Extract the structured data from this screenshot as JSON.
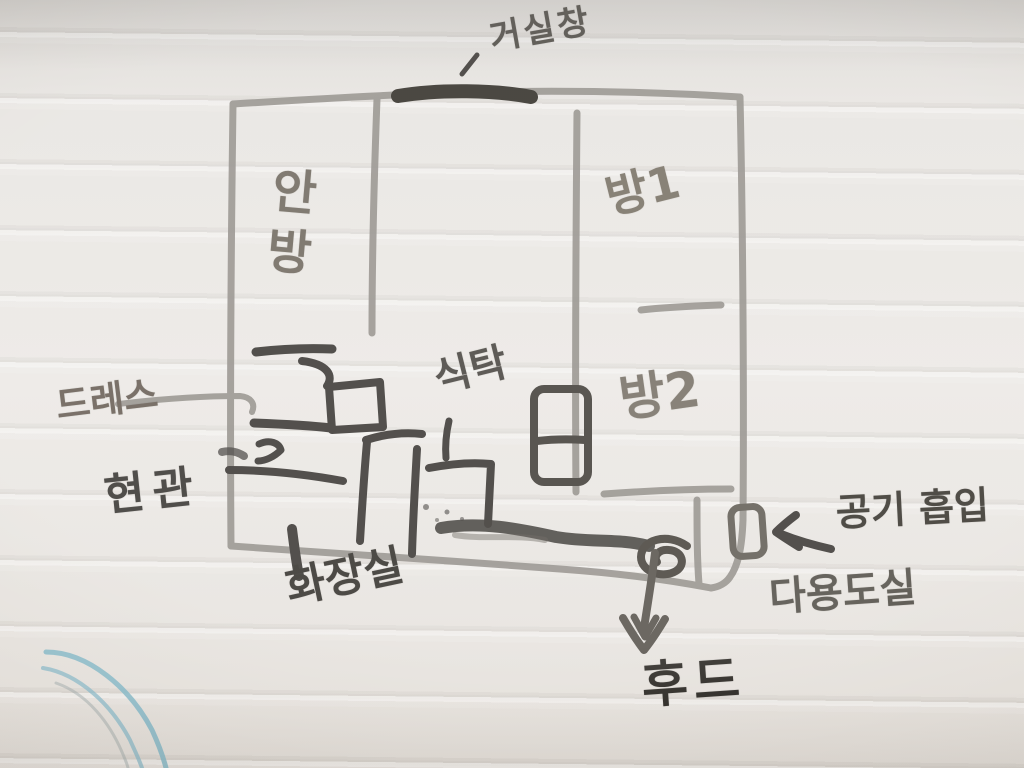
{
  "labels": {
    "living_room_window": "거실창",
    "master_bedroom": "안방",
    "room1": "방1",
    "room2": "방2",
    "dining_table": "식탁",
    "dress_room": "드레스",
    "entrance": "현관",
    "bathroom": "화장실",
    "air_intake": "공기 흡입",
    "utility_room": "다용도실",
    "hood": "후드"
  },
  "colors": {
    "board_background": "#e8e5e1",
    "wall_marker_gray": "#8a8680",
    "detail_marker_black": "#2d2a26",
    "hood_arrow_gray": "#4c4740",
    "stray_marker_blue": "#86b7c6"
  }
}
